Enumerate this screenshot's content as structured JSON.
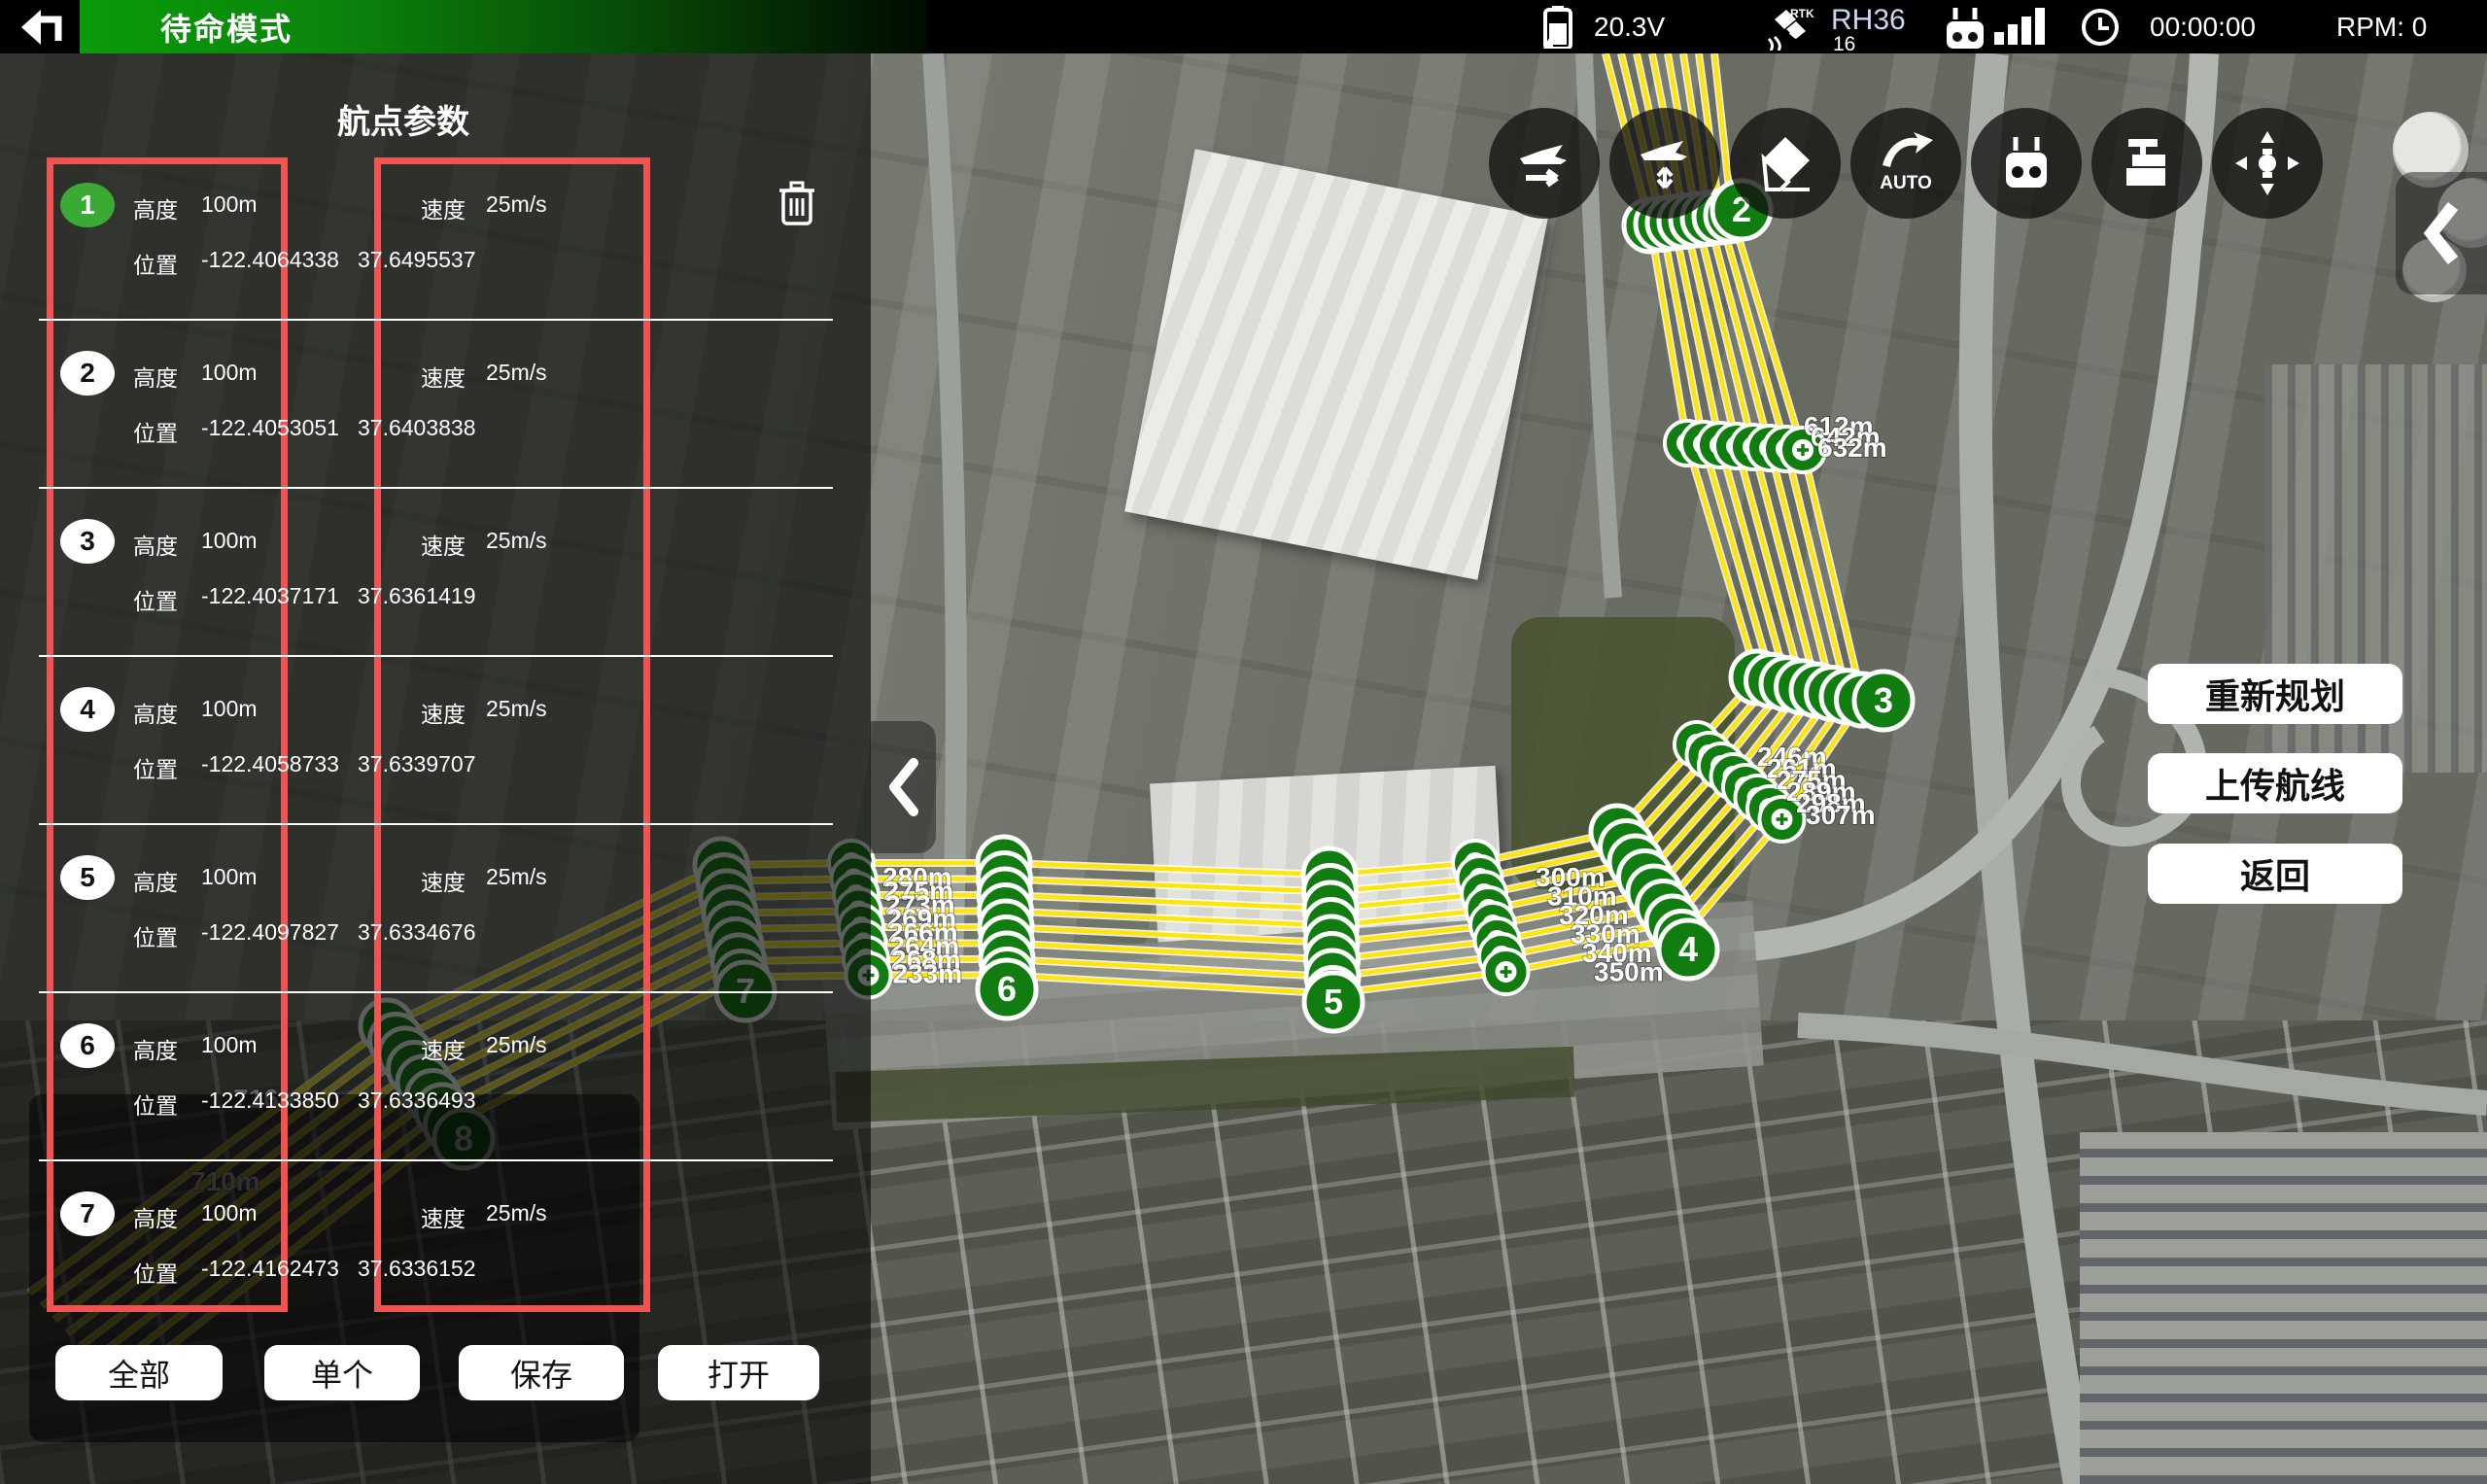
{
  "top_bar": {
    "mode_label": "待命模式",
    "battery_voltage": "20.3V",
    "rtk": {
      "badge": "RTK",
      "name": "RH36",
      "count": "16"
    },
    "time": "00:00:00",
    "rpm": "RPM: 0"
  },
  "panel": {
    "title": "航点参数",
    "alt_label": "高度",
    "pos_label": "位置",
    "speed_label": "速度",
    "waypoints": [
      {
        "id": "1",
        "alt": "100m",
        "lon": "-122.4064338",
        "lat": "37.6495537",
        "speed": "25m/s"
      },
      {
        "id": "2",
        "alt": "100m",
        "lon": "-122.4053051",
        "lat": "37.6403838",
        "speed": "25m/s"
      },
      {
        "id": "3",
        "alt": "100m",
        "lon": "-122.4037171",
        "lat": "37.6361419",
        "speed": "25m/s"
      },
      {
        "id": "4",
        "alt": "100m",
        "lon": "-122.4058733",
        "lat": "37.6339707",
        "speed": "25m/s"
      },
      {
        "id": "5",
        "alt": "100m",
        "lon": "-122.4097827",
        "lat": "37.6334676",
        "speed": "25m/s"
      },
      {
        "id": "6",
        "alt": "100m",
        "lon": "-122.4133850",
        "lat": "37.6336493",
        "speed": "25m/s"
      },
      {
        "id": "7",
        "alt": "100m",
        "lon": "-122.4162473",
        "lat": "37.6336152",
        "speed": "25m/s"
      }
    ],
    "buttons": {
      "all": "全部",
      "single": "单个",
      "save": "保存",
      "open": "打开"
    }
  },
  "map": {
    "actions": {
      "replan": "重新规划",
      "upload": "上传航线",
      "back": "返回"
    },
    "auto_label": "AUTO",
    "markers": [
      "2",
      "3",
      "4",
      "5",
      "6",
      "7",
      "8"
    ],
    "labels": {
      "between_2_3": [
        "612m",
        "642m",
        "632m"
      ],
      "near_3": [
        "246m",
        "261m",
        "275m",
        "289m",
        "298m",
        "307m"
      ],
      "near_4": [
        "300m",
        "310m",
        "320m",
        "330m",
        "340m",
        "350m"
      ],
      "near_6": [
        "280m",
        "275m",
        "273m",
        "269m",
        "266m",
        "264m",
        "268m",
        "233m"
      ],
      "dim_near_8": [
        "716m",
        "710m"
      ]
    }
  },
  "colors": {
    "accent_green": "#0a9b0a",
    "badge_active_green": "#3aaa35",
    "marker_green": "#117d11",
    "route_yellow": "#ffe608",
    "highlight_red": "#f05352"
  }
}
